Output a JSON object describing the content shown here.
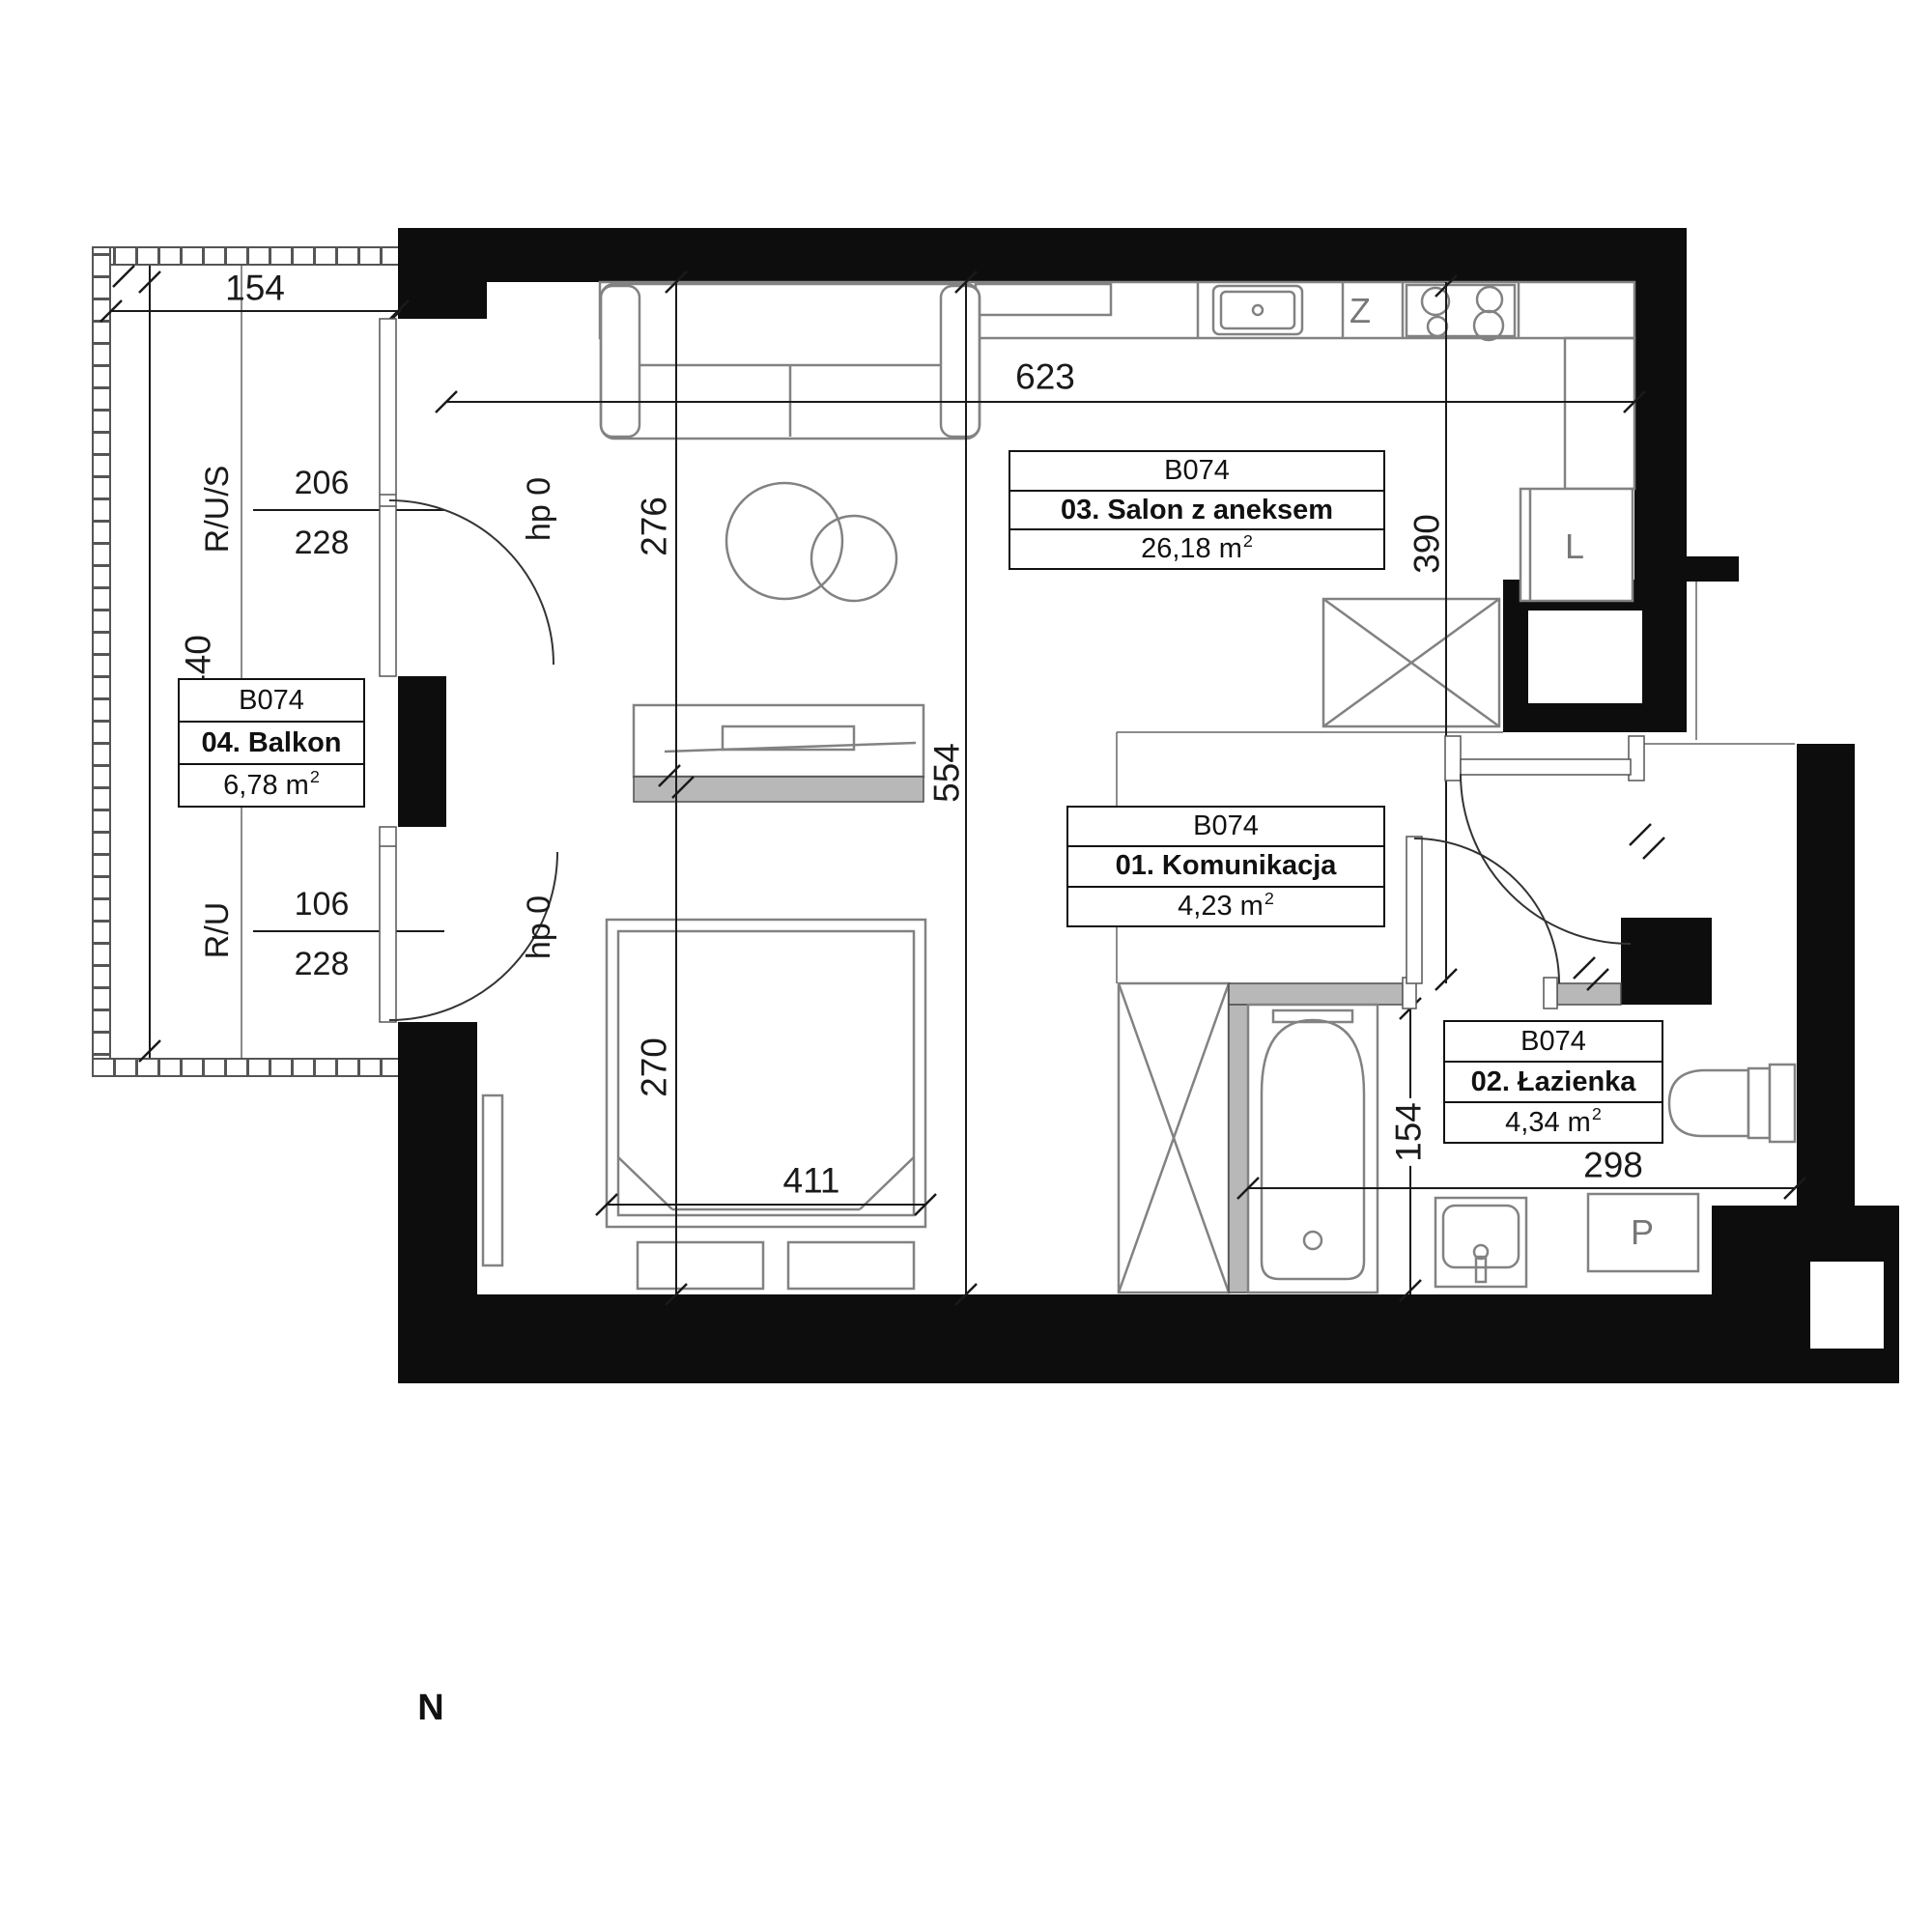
{
  "meta": {
    "unit_code": "B074",
    "plan_type": "apartment floor plan"
  },
  "rooms": {
    "balkon": {
      "code": "B074",
      "name": "04. Balkon",
      "area": "6,78 m",
      "sup": "2"
    },
    "salon": {
      "code": "B074",
      "name": "03. Salon z aneksem",
      "area": "26,18 m",
      "sup": "2"
    },
    "komunikacja": {
      "code": "B074",
      "name": "01. Komunikacja",
      "area": "4,23 m",
      "sup": "2"
    },
    "lazienka": {
      "code": "B074",
      "name": "02. Łazienka",
      "area": "4,34 m",
      "sup": "2"
    }
  },
  "dimensions": {
    "balcony_width": "154",
    "balcony_depth": "440",
    "salon_width": "623",
    "salon_upper_depth": "276",
    "salon_total_depth": "554",
    "bed_zone_depth": "270",
    "bed_width": "411",
    "kitchen_depth": "390",
    "bath_strip": "154",
    "bath_width": "298"
  },
  "windows": {
    "upper": {
      "label": "R/U/S",
      "width": "206",
      "height": "228"
    },
    "lower": {
      "label": "R/U",
      "width": "106",
      "height": "228"
    },
    "sill_upper": "hp 0",
    "sill_lower": "hp 0"
  },
  "appliances": {
    "sink": "Z",
    "fridge": "L",
    "washer": "P"
  },
  "compass": {
    "north": "N"
  },
  "colors": {
    "wall": "#0d0d0d",
    "furn": "#828282",
    "part": "#b8b8b8",
    "dim": "#1a1a1a",
    "glyph": "#777777"
  }
}
